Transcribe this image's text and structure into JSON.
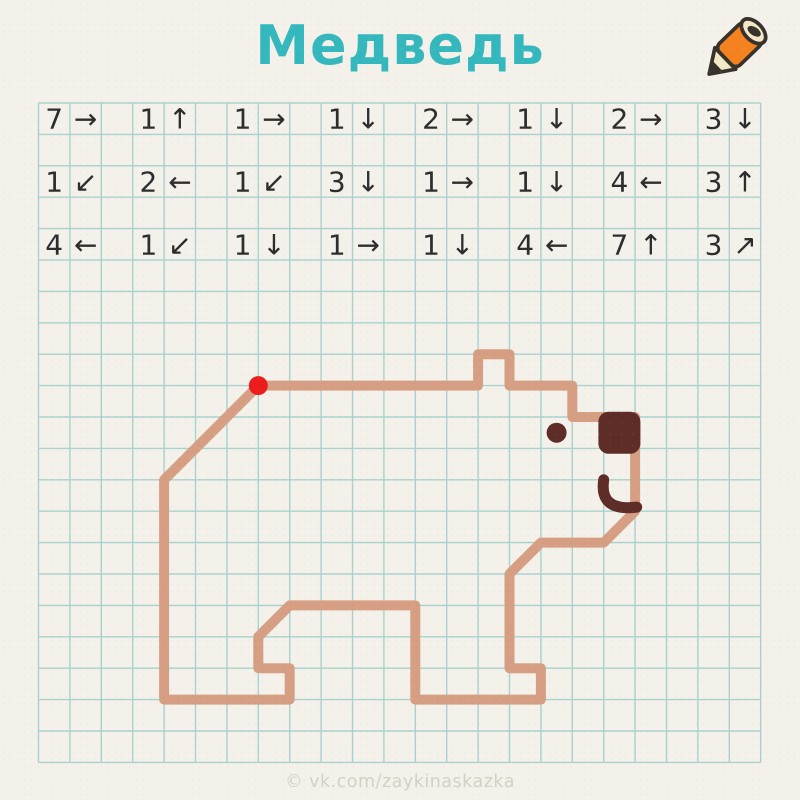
{
  "title": "Медведь",
  "watermark": "© vk.com/zaykinaskazka",
  "colors": {
    "paper": "#f3f1ea",
    "grid": "#a9d2cf",
    "text": "#2d2d2d",
    "title": "#35b8bd",
    "line": "#d69f83",
    "dark": "#5e2d28",
    "start_dot": "#ed1c1c",
    "watermark": "#d4d0c6",
    "pencil_body": "#f58220",
    "pencil_wood": "#f3e9c6",
    "pencil_outline": "#37322c"
  },
  "grid": {
    "cols": 23,
    "rows": 21,
    "cell": 31.4,
    "origin_x": 38.5,
    "origin_y": 103
  },
  "instruction_rows": [
    0,
    2,
    4
  ],
  "instructions": [
    [
      {
        "n": "7",
        "d": "→"
      },
      {
        "n": "1",
        "d": "↑"
      },
      {
        "n": "1",
        "d": "→"
      },
      {
        "n": "1",
        "d": "↓"
      },
      {
        "n": "2",
        "d": "→"
      },
      {
        "n": "1",
        "d": "↓"
      },
      {
        "n": "2",
        "d": "→"
      },
      {
        "n": "3",
        "d": "↓"
      }
    ],
    [
      {
        "n": "1",
        "d": "↙"
      },
      {
        "n": "2",
        "d": "←"
      },
      {
        "n": "1",
        "d": "↙"
      },
      {
        "n": "3",
        "d": "↓"
      },
      {
        "n": "1",
        "d": "→"
      },
      {
        "n": "1",
        "d": "↓"
      },
      {
        "n": "4",
        "d": "←"
      },
      {
        "n": "3",
        "d": "↑"
      }
    ],
    [
      {
        "n": "4",
        "d": "←"
      },
      {
        "n": "1",
        "d": "↙"
      },
      {
        "n": "1",
        "d": "↓"
      },
      {
        "n": "1",
        "d": "→"
      },
      {
        "n": "1",
        "d": "↓"
      },
      {
        "n": "4",
        "d": "←"
      },
      {
        "n": "7",
        "d": "↑"
      },
      {
        "n": "3",
        "d": "↗"
      }
    ]
  ],
  "drawing": {
    "start": {
      "col": 7,
      "row": 9
    },
    "line_width": 10,
    "start_dot_radius": 9.5
  },
  "face": {
    "eye": {
      "col": 16.5,
      "row": 10.5,
      "r": 10
    },
    "nose": {
      "col": 18.5,
      "row": 10.5,
      "size": 42,
      "corner": 10
    },
    "mouth": {
      "path_cells": [
        [
          18.0,
          12.0
        ],
        [
          17.9,
          12.68
        ],
        [
          18.25,
          12.97
        ],
        [
          19.05,
          12.87
        ]
      ],
      "width": 11
    }
  }
}
